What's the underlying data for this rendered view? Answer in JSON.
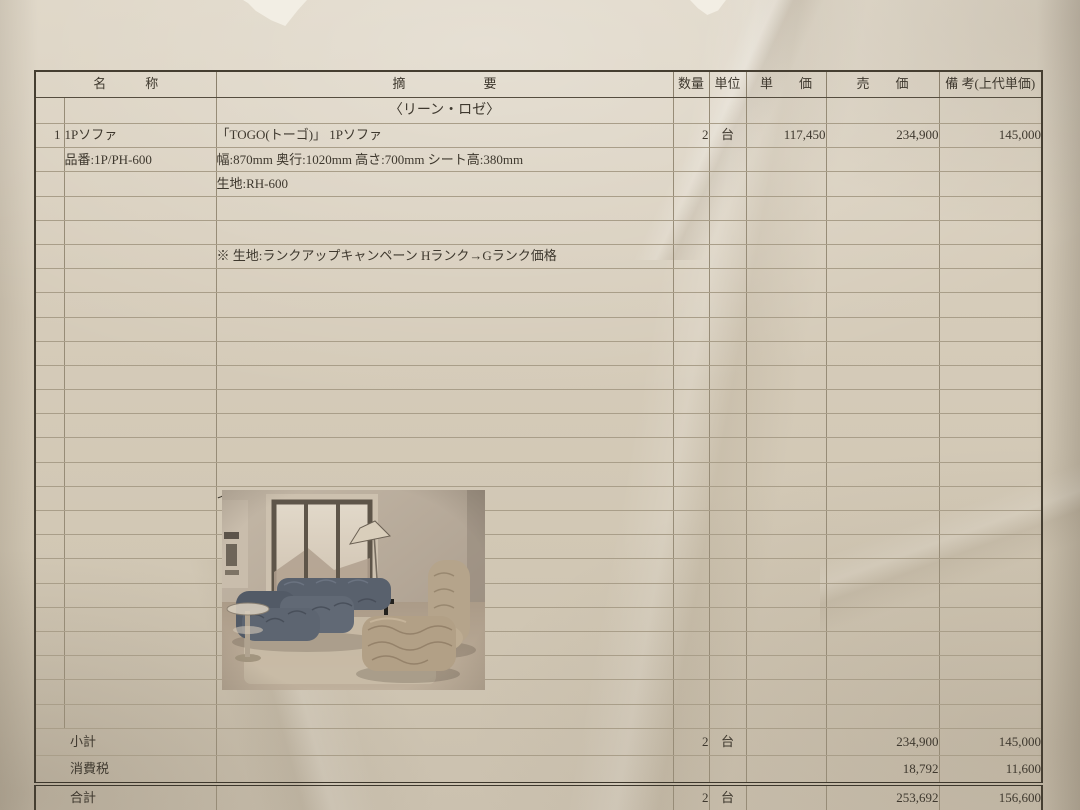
{
  "colors": {
    "paper": "#d3c9b7",
    "ink": "#3e382e",
    "grid_line": "#a99e89",
    "photo_sofa_blue": "#5a626e",
    "photo_sofa_beige": "#b5a48b"
  },
  "table": {
    "headers": {
      "name": "名　　　称",
      "desc": "摘　　　　　　要",
      "qty": "数量",
      "unit": "単位",
      "unit_price": "単　　価",
      "sell_price": "売　　価",
      "remarks": "備 考(上代単価)"
    },
    "brand_row": "〈リーン・ロゼ〉",
    "item": {
      "no": "1",
      "name": "1Pソファ",
      "desc": "「TOGO(トーゴ)」 1Pソファ",
      "qty": "2",
      "unit": "台",
      "unit_price": "117,450",
      "sell_price": "234,900",
      "remarks": "145,000",
      "model": "品番:1P/PH-600",
      "specs": "幅:870mm 奥行:1020mm 高さ:700mm シート高:380mm",
      "fabric": "生地:RH-600",
      "note": "※ 生地:ランクアップキャンペーン Hランク→Gランク価格"
    },
    "image_label": "イメージ画像",
    "subtotal": {
      "label": "小計",
      "qty": "2",
      "unit": "台",
      "sell_price": "234,900",
      "remarks": "145,000"
    },
    "tax": {
      "label": "消費税",
      "sell_price": "18,792",
      "remarks": "11,600"
    },
    "total": {
      "label": "合計",
      "qty": "2",
      "unit": "台",
      "sell_price": "253,692",
      "remarks": "156,600"
    }
  }
}
